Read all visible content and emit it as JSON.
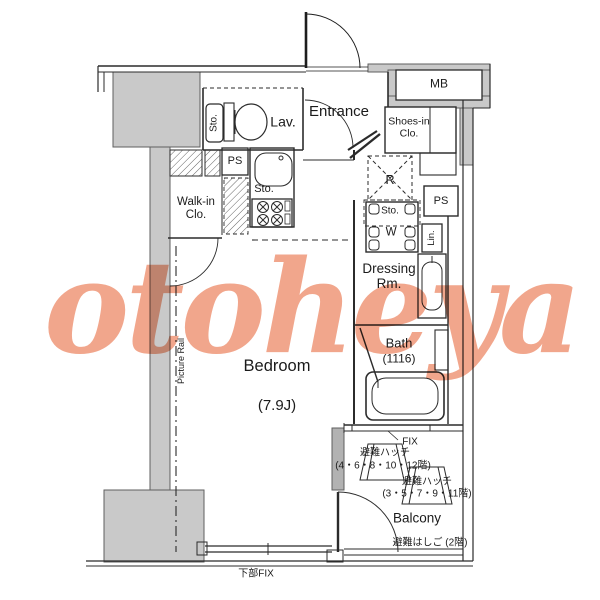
{
  "watermark": {
    "text": "otoheya",
    "color": "#f09a7c"
  },
  "colors": {
    "wall_gray": "#c9c9c9",
    "wall_dark_gray": "#b2b2b2",
    "line": "#2b2b2b"
  },
  "rooms": {
    "lavatory": "Lav.",
    "entrance": "Entrance",
    "shoes_in_closet_line1": "Shoes-in",
    "shoes_in_closet_line2": "Clo.",
    "meter_box": "MB",
    "walk_in_closet_line1": "Walk-in",
    "walk_in_closet_line2": "Clo.",
    "dressing_room_line1": "Dressing",
    "dressing_room_line2": "Rm.",
    "bath": "Bath",
    "bath_size": "(1116)",
    "bedroom": "Bedroom",
    "bedroom_size": "(7.9J)",
    "balcony": "Balcony"
  },
  "fixtures": {
    "ps_kitchen": "PS",
    "ps_right": "PS",
    "refrigerator": "R",
    "washer": "W",
    "linen": "Lin.",
    "storage_toilet": "Sto.",
    "storage_kitchen": "Sto.",
    "storage_laundry": "Sto.",
    "picture_rail": "Picture Rail"
  },
  "annotations": {
    "fix": "FIX",
    "hatch_upper_name": "避難ハッチ",
    "hatch_upper_floors": "(4・6・8・10・12階)",
    "hatch_lower_name": "避難ハッチ",
    "hatch_lower_floors": "(3・5・7・9・11階)",
    "escape_ladder": "避難はしご (2階)",
    "bottom_fix": "下部FIX"
  }
}
